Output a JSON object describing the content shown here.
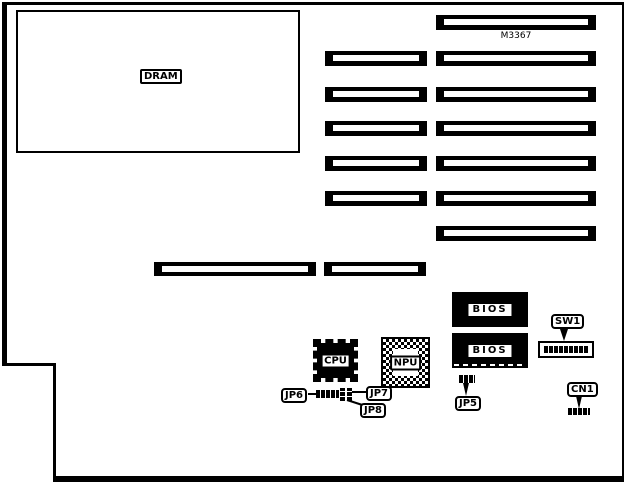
{
  "board": {
    "part_number": "M3367",
    "colors": {
      "ink": "#000000",
      "paper": "#ffffff"
    },
    "expansion_slots": {
      "long_count": 8,
      "short_count": 6
    }
  },
  "components": {
    "dram": {
      "label": "DRAM"
    },
    "cpu": {
      "label": "CPU"
    },
    "npu": {
      "label": "NPU"
    },
    "bios1": {
      "label": "BIOS"
    },
    "bios2": {
      "label": "BIOS"
    },
    "sw1": {
      "label": "SW1"
    },
    "cn1": {
      "label": "CN1"
    },
    "jp5": {
      "label": "JP5"
    },
    "jp6": {
      "label": "JP6"
    },
    "jp7": {
      "label": "JP7"
    },
    "jp8": {
      "label": "JP8"
    }
  }
}
